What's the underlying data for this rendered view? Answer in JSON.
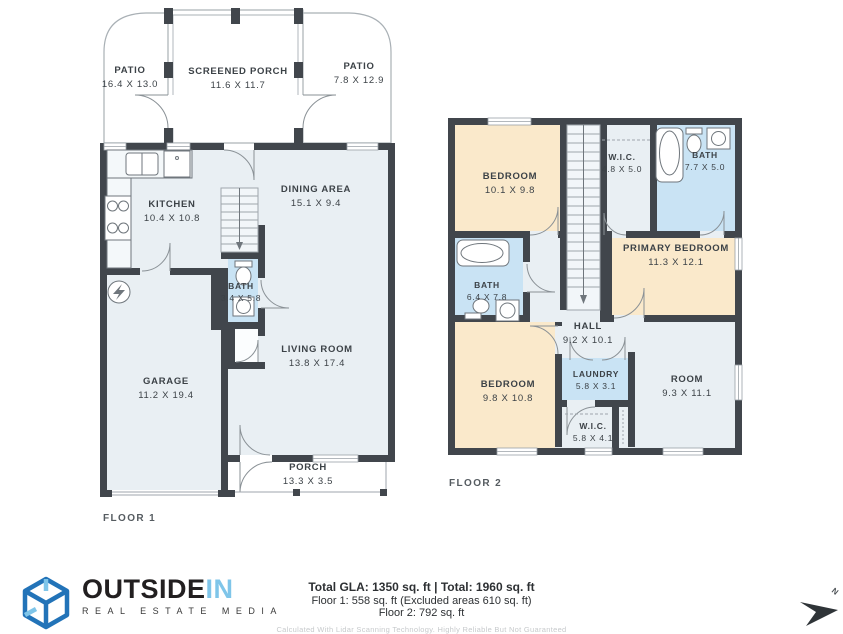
{
  "floor1": {
    "label": "FLOOR 1",
    "rooms": {
      "patio_left": {
        "name": "PATIO",
        "dims": "16.4 X 13.0"
      },
      "screened_porch": {
        "name": "SCREENED PORCH",
        "dims": "11.6 X 11.7"
      },
      "patio_right": {
        "name": "PATIO",
        "dims": "7.8 X 12.9"
      },
      "kitchen": {
        "name": "KITCHEN",
        "dims": "10.4 X 10.8"
      },
      "dining": {
        "name": "DINING AREA",
        "dims": "15.1 X 9.4"
      },
      "bath": {
        "name": "BATH",
        "dims": "3.4 X 5.8"
      },
      "garage": {
        "name": "GARAGE",
        "dims": "11.2 X 19.4"
      },
      "living": {
        "name": "LIVING ROOM",
        "dims": "13.8 X 17.4"
      },
      "porch": {
        "name": "PORCH",
        "dims": "13.3 X 3.5"
      }
    }
  },
  "floor2": {
    "label": "FLOOR 2",
    "rooms": {
      "bedroom_top": {
        "name": "BEDROOM",
        "dims": "10.1 X 9.8"
      },
      "wic_top": {
        "name": "W.I.C.",
        "dims": "4.8 X 5.0"
      },
      "bath_top": {
        "name": "BATH",
        "dims": "7.7 X 5.0"
      },
      "primary_bedroom": {
        "name": "PRIMARY BEDROOM",
        "dims": "11.3 X 12.1"
      },
      "bath_mid": {
        "name": "BATH",
        "dims": "6.4 X 7.8"
      },
      "hall": {
        "name": "HALL",
        "dims": "9.2 X 10.1"
      },
      "bedroom_bottom": {
        "name": "BEDROOM",
        "dims": "9.8 X 10.8"
      },
      "laundry": {
        "name": "LAUNDRY",
        "dims": "5.8 X 3.1"
      },
      "room": {
        "name": "ROOM",
        "dims": "9.3 X 11.1"
      },
      "wic_bottom": {
        "name": "W.I.C.",
        "dims": "5.8 X 4.1"
      }
    }
  },
  "footer": {
    "totals_line": "Total GLA: 1350 sq. ft | Total: 1960 sq. ft",
    "floor1_line": "Floor 1: 558 sq. ft (Excluded areas 610 sq. ft)",
    "floor2_line": "Floor 2: 792 sq. ft",
    "disclaimer": "Calculated With Lidar Scanning Technology. Highly Reliable But Not Guaranteed"
  },
  "logo": {
    "word1": "OUTSIDE",
    "word2": "IN",
    "tagline": "REAL ESTATE MEDIA"
  },
  "compass": {
    "label": "N"
  },
  "colors": {
    "wall": "#41464C",
    "room_light": "#E9EFF3",
    "room_warm": "#FAE9CB",
    "room_wet": "#C9E3F4",
    "brand_blue": "#2273B8",
    "brand_light_blue": "#7FC5E9",
    "brand_dark": "#221F20"
  }
}
